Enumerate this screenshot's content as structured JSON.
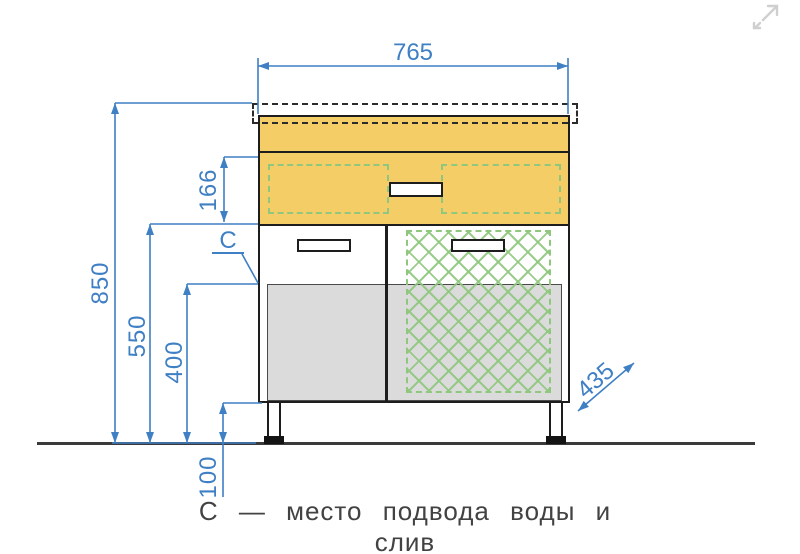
{
  "drawing": {
    "title_hint": "vanity cabinet front-view dimension drawing",
    "dimensions": {
      "width": "765",
      "height_total": "850",
      "height_drawers_bottom": "550",
      "height_doors_top": "400",
      "drawer_front_height": "166",
      "leg_height": "100",
      "depth": "435"
    },
    "callout_c": "С",
    "caption": "С — место подвода воды и слив",
    "colors": {
      "dimension_blue": "#3f7fc4",
      "cabinet_yellow": "#f5cd66",
      "lattice_green": "#8fc77e",
      "door_gray": "#dbdbdb",
      "outline_black": "#1d1d1d",
      "floor_gray": "#3a3a3a"
    },
    "icons": {
      "top_right": "expand-icon"
    }
  }
}
